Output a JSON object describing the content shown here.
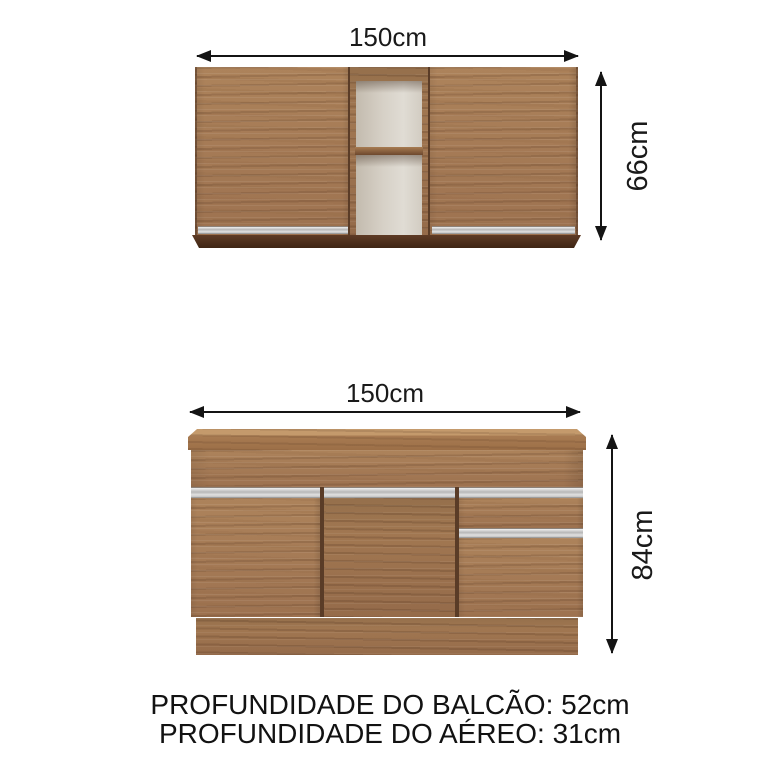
{
  "diagram": {
    "upper_cabinet": {
      "width_label": "150cm",
      "height_label": "66cm"
    },
    "lower_cabinet": {
      "width_label": "150cm",
      "height_label": "84cm"
    },
    "footer": {
      "line1": "PROFUNDIDADE DO BALCÃO: 52cm",
      "line2": "PROFUNDIDADE DO AÉREO: 31cm"
    },
    "colors": {
      "wood": "#a57b55",
      "wood_dark": "#5a3c27",
      "board_dark": "#4a2d1b",
      "silver": "#c9c9c9",
      "interior_light": "#d9d3c9",
      "arrow": "#141414",
      "text": "#1a1a1a",
      "background": "#ffffff"
    }
  }
}
